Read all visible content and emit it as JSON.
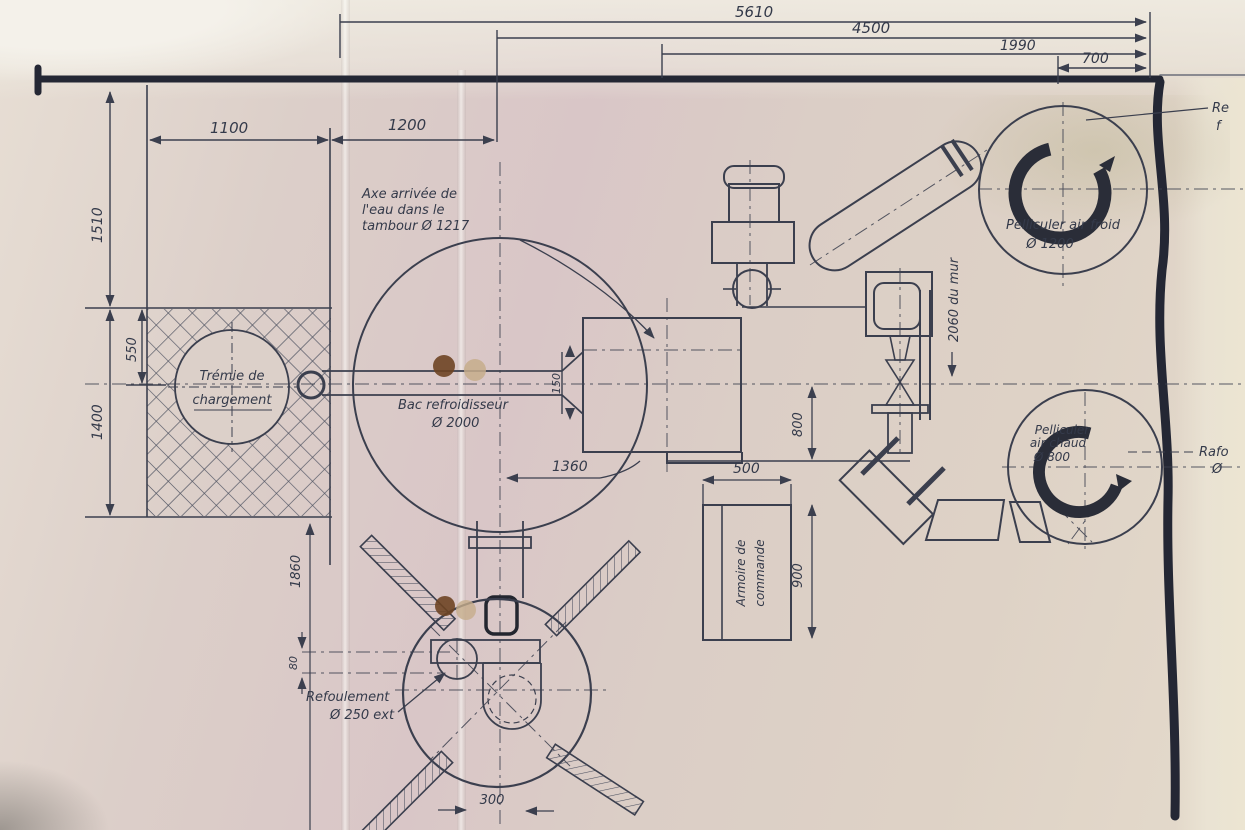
{
  "document": {
    "kind": "scanned hand-drawn machine installation plan",
    "language": "French"
  },
  "colors": {
    "ink": "#3b3f4e",
    "heavy_border": "#242734",
    "paper": "#dbcec7",
    "punch_hole_dark": "#6e4423",
    "punch_hole_faded": "#c5ad8b"
  },
  "dims": {
    "w5610": "5610",
    "w4500": "4500",
    "w1990": "1990",
    "w700": "700",
    "w1100": "1100",
    "w1200": "1200",
    "h1510": "1510",
    "h550": "550",
    "h1400": "1400",
    "w1360": "1360",
    "p150": "150",
    "h800": "800",
    "w500": "500",
    "h900": "900",
    "h1860": "1860",
    "p80": "80",
    "w300": "300",
    "wall_offset": "2060 du mur"
  },
  "labels": {
    "tremie1": "Trémie de",
    "tremie2": "chargement",
    "axe1": "Axe arrivée de",
    "axe2": "l'eau dans le",
    "axe3": "tambour    Ø 1217",
    "bac1": "Bac refroidisseur",
    "bac2": "Ø 2000",
    "fanfroid1": "Pelliculer air froid",
    "fanfroid2": "Ø 1200",
    "fanchaud1": "Pelliculer",
    "fanchaud2": "air chaud",
    "fanchaud3": "Ø 800",
    "refoul1": "Refoulement",
    "refoul2": "Ø 250 ext",
    "armoire1": "Armoire de",
    "armoire2": "commande",
    "edge_top1": "Re",
    "edge_top2": "f",
    "edge_right1": "Rafo",
    "edge_right2": "Ø"
  }
}
